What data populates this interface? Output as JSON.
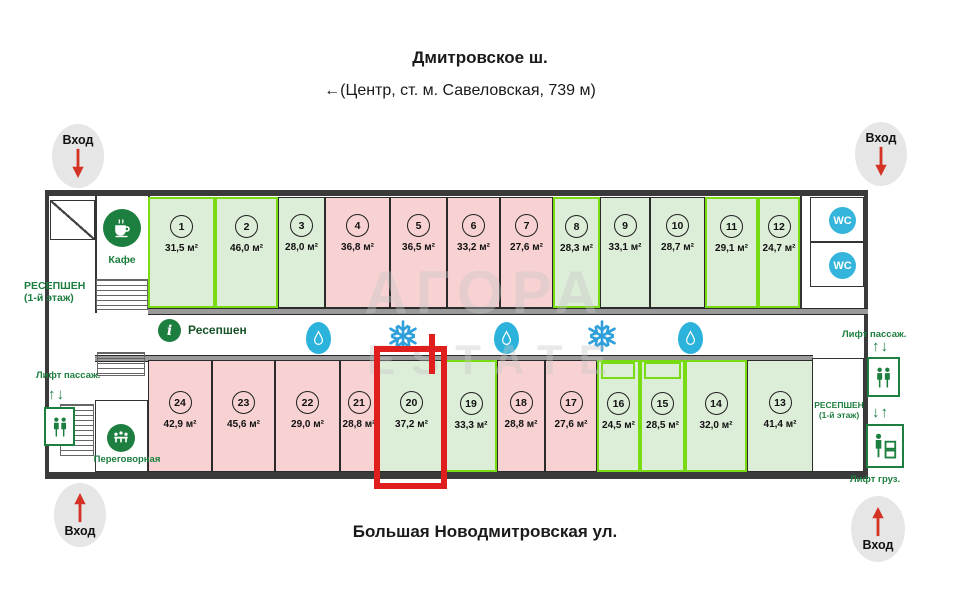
{
  "streets": {
    "top_title": "Дмитровское ш.",
    "top_subtitle": "←(Центр, ст. м. Савеловская, 739 м)",
    "bottom_title": "Большая Новодмитровская ул."
  },
  "watermark": {
    "line1": "АГОРА",
    "line2": "ESTATE"
  },
  "labels": {
    "entrance": "Вход",
    "cafe": "Кафе",
    "reception_floor": "РЕСЕПШЕН",
    "reception_floor_sub": "(1-й этаж)",
    "reception_desk": "Ресепшен",
    "meeting_room": "Переговорная",
    "lift_passenger": "Лифт пассаж.",
    "lift_freight": "Лифт груз.",
    "wc": "WC",
    "arrows_up_down": "↑↓",
    "arrows_down_up": "↓↑",
    "info_i": "i"
  },
  "corridor_icons": [
    "info-icon",
    "water-drop-icon",
    "snowflake-icon",
    "water-drop-icon",
    "snowflake-icon",
    "water-drop-icon"
  ],
  "units_top": [
    {
      "num": "1",
      "area": "31,5 м²",
      "status": "available-bright"
    },
    {
      "num": "2",
      "area": "46,0 м²",
      "status": "available-bright"
    },
    {
      "num": "3",
      "area": "28,0 м²",
      "status": "available"
    },
    {
      "num": "4",
      "area": "36,8 м²",
      "status": "occupied"
    },
    {
      "num": "5",
      "area": "36,5 м²",
      "status": "occupied"
    },
    {
      "num": "6",
      "area": "33,2 м²",
      "status": "occupied"
    },
    {
      "num": "7",
      "area": "27,6 м²",
      "status": "occupied"
    },
    {
      "num": "8",
      "area": "28,3 м²",
      "status": "available-bright"
    },
    {
      "num": "9",
      "area": "33,1 м²",
      "status": "available"
    },
    {
      "num": "10",
      "area": "28,7 м²",
      "status": "available"
    },
    {
      "num": "11",
      "area": "29,1 м²",
      "status": "available-bright"
    },
    {
      "num": "12",
      "area": "24,7 м²",
      "status": "available-bright"
    }
  ],
  "units_bottom": [
    {
      "num": "24",
      "area": "42,9 м²",
      "status": "occupied"
    },
    {
      "num": "23",
      "area": "45,6 м²",
      "status": "occupied"
    },
    {
      "num": "22",
      "area": "29,0 м²",
      "status": "occupied"
    },
    {
      "num": "21",
      "area": "28,8 м²",
      "status": "occupied"
    },
    {
      "num": "20",
      "area": "37,2 м²",
      "status": "available",
      "highlighted": true
    },
    {
      "num": "19",
      "area": "33,3 м²",
      "status": "available-bright"
    },
    {
      "num": "18",
      "area": "28,8 м²",
      "status": "occupied"
    },
    {
      "num": "17",
      "area": "27,6 м²",
      "status": "occupied"
    },
    {
      "num": "16",
      "area": "24,5 м²",
      "status": "available-bright"
    },
    {
      "num": "15",
      "area": "28,5 м²",
      "status": "available-bright"
    },
    {
      "num": "14",
      "area": "32,0 м²",
      "status": "available-bright"
    },
    {
      "num": "13",
      "area": "41,4 м²",
      "status": "available"
    }
  ],
  "highlight": {
    "unit": "20"
  },
  "colors": {
    "available_fill": "#dcedd8",
    "available_bright_border": "#79dc12",
    "occupied_fill": "#f8d2d2",
    "wall": "#3a3a3a",
    "highlight_red": "#e01e1e",
    "icon_green": "#1d7f3f",
    "icon_blue": "#2fa8da",
    "entrance_arrow_red": "#d43225",
    "watermark_gray": "#c7c7c7"
  }
}
